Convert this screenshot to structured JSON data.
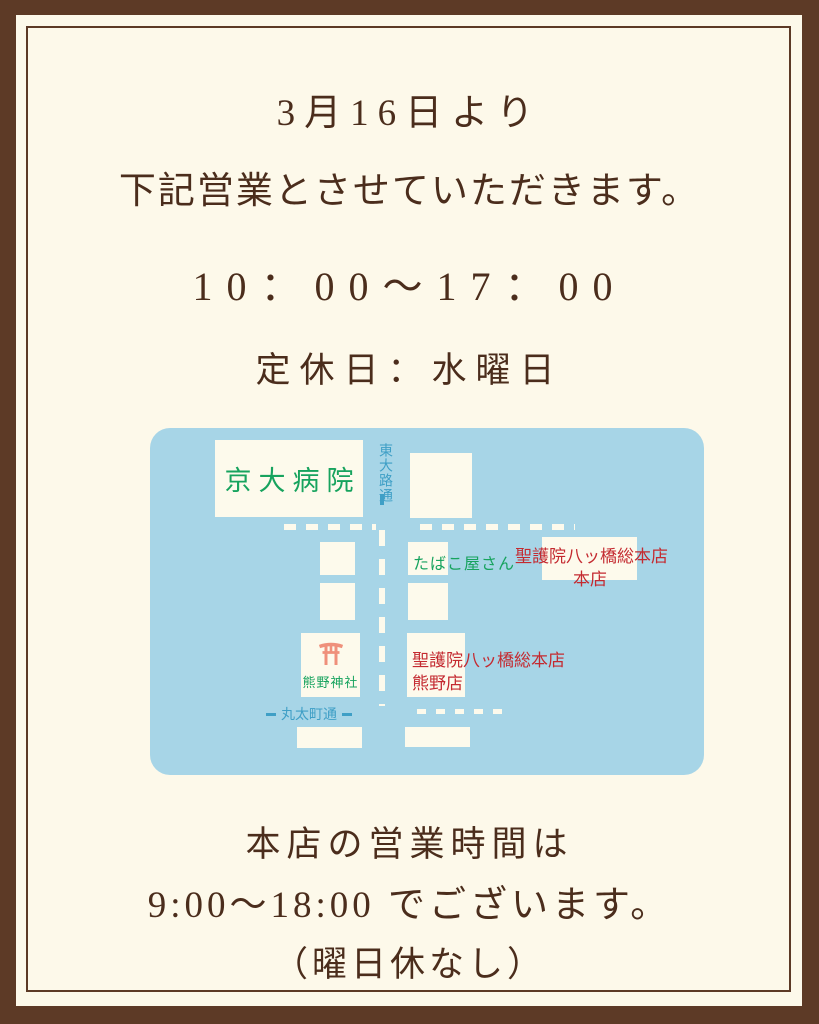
{
  "notice": {
    "date_line": "3月16日より",
    "announce_line": "下記営業とさせていただきます。",
    "hours": "10：00～17：00",
    "closed": "定休日：水曜日"
  },
  "map": {
    "hospital": "京大病院",
    "street_vertical": "東大路通",
    "street_horizontal": "丸太町通",
    "tobacco_shop": "たばこ屋さん",
    "honten_name": "聖護院八ッ橋総本店",
    "honten_branch": "本店",
    "shrine": "熊野神社",
    "kumano_name": "聖護院八ッ橋総本店",
    "kumano_branch": "熊野店"
  },
  "footer": {
    "line1": "本店の営業時間は",
    "line2": "9:00～18:00 でございます。",
    "line3": "（曜日休なし）"
  },
  "colors": {
    "background": "#fdf9ea",
    "frame_brown": "#5d3a26",
    "text_brown": "#4b2d1c",
    "map_blue": "#a7d5e7",
    "box_cream": "#fdfaec",
    "green": "#17a35e",
    "red": "#c42a30",
    "street_blue": "#3f9fc6",
    "torii_salmon": "#ef907b"
  }
}
